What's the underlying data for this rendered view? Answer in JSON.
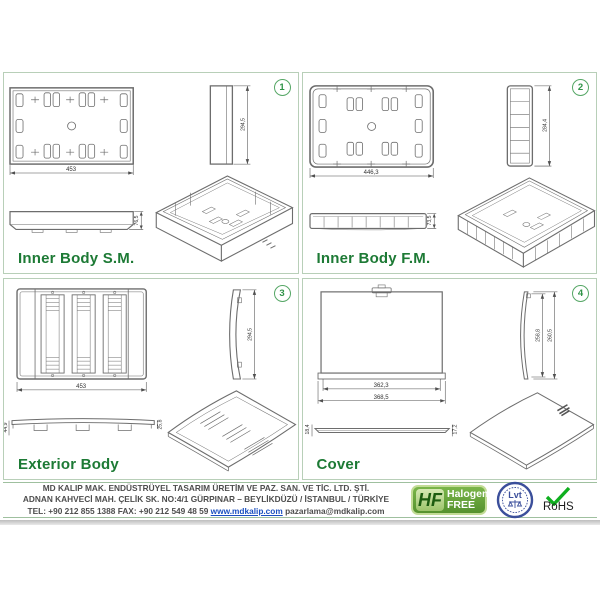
{
  "colors": {
    "title_green": "#1d7a35",
    "border_green": "#b8cfb8",
    "link_blue": "#1a4fc0",
    "hf_green": "#55922e",
    "lvt_blue": "#3b4f9b",
    "rohs_check": "#0faf1f"
  },
  "panels": [
    {
      "number": "1",
      "title": "Inner Body S.M.",
      "dim_width": "453",
      "dim_height": "294,5",
      "dim_depth": "76,5"
    },
    {
      "number": "2",
      "title": "Inner Body F.M.",
      "dim_width": "446,3",
      "dim_height": "284,4",
      "dim_depth": "73,5"
    },
    {
      "number": "3",
      "title": "Exterior Body",
      "dim_width": "453",
      "dim_height": "294,5",
      "dim_depth_left": "44,9",
      "dim_depth_right": "25,8"
    },
    {
      "number": "4",
      "title": "Cover",
      "dim_width_inner": "362,3",
      "dim_width_outer": "368,5",
      "dim_height_inner": "258,8",
      "dim_height_outer": "260,5",
      "dim_depth_left": "18,4",
      "dim_depth_right": "17,2"
    }
  ],
  "footer": {
    "company_line1": "MD KALIP MAK. ENDÜSTRÜYEL TASARIM ÜRETİM VE PAZ. SAN. VE TİC. LTD. ŞTİ.",
    "company_line2": "ADNAN KAHVECİ MAH. ÇELİK SK. NO:4/1 GÜRPINAR – BEYLİKDÜZÜ / İSTANBUL / TÜRKİYE",
    "contact_prefix": "TEL: +90 212 855 1388  FAX: +90 212 549 48 59",
    "website": "www.mdkalip.com",
    "email": "pazarlama@mdkalip.com",
    "logos": {
      "halogen_free": {
        "abbr": "HF",
        "line1": "Halogen",
        "line2": "FREE"
      },
      "lvt": {
        "text": "Lvt"
      },
      "rohs": {
        "label": "RoHS"
      }
    }
  }
}
